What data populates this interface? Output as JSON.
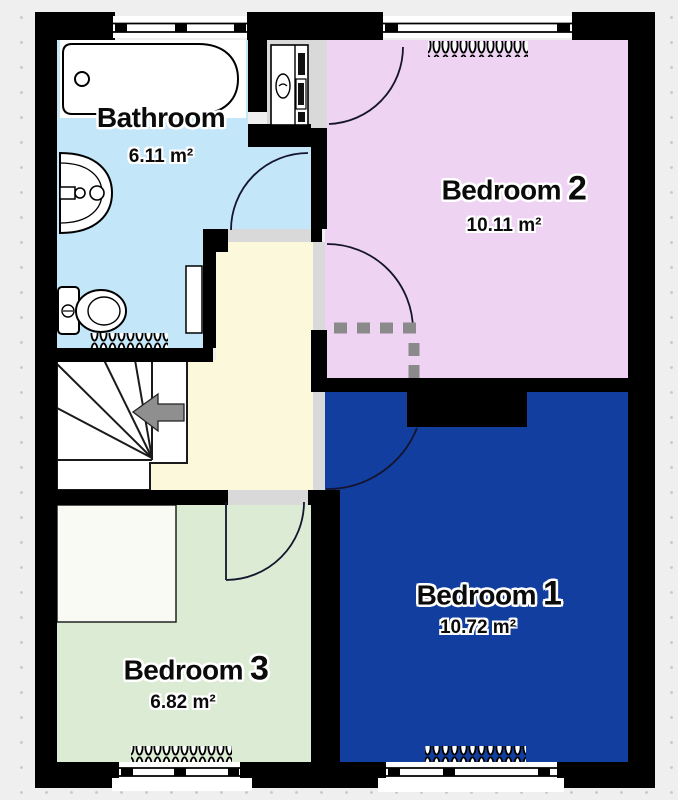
{
  "plan": {
    "colors": {
      "background": "#efefef",
      "wall": "#000000",
      "door_opening": "#d9d9d9",
      "hall": "#fbf8dc",
      "stairs": "#ffffff",
      "closet": "#d9d9d9",
      "dashed_line": "#8a8a8a",
      "arrow": "#8f8f8f"
    },
    "rooms": {
      "bathroom": {
        "name": "Bathroom",
        "number": "",
        "area": "6.11 m²",
        "color": "#c4e6f9"
      },
      "bedroom2": {
        "name": "Bedroom",
        "number": "2",
        "area": "10.11 m²",
        "color": "#eed3f3"
      },
      "bedroom1": {
        "name": "Bedroom",
        "number": "1",
        "area": "10.72 m²",
        "color": "#123f9f"
      },
      "bedroom3": {
        "name": "Bedroom",
        "number": "3",
        "area": "6.82 m²",
        "color": "#dcecd4"
      }
    },
    "stairs": {
      "direction": "left"
    },
    "fixtures": {
      "bathtub": "bathtub",
      "sink": "sink",
      "toilet": "toilet",
      "boiler_cupboard": "boiler-cupboard",
      "radiators": "radiator"
    }
  }
}
